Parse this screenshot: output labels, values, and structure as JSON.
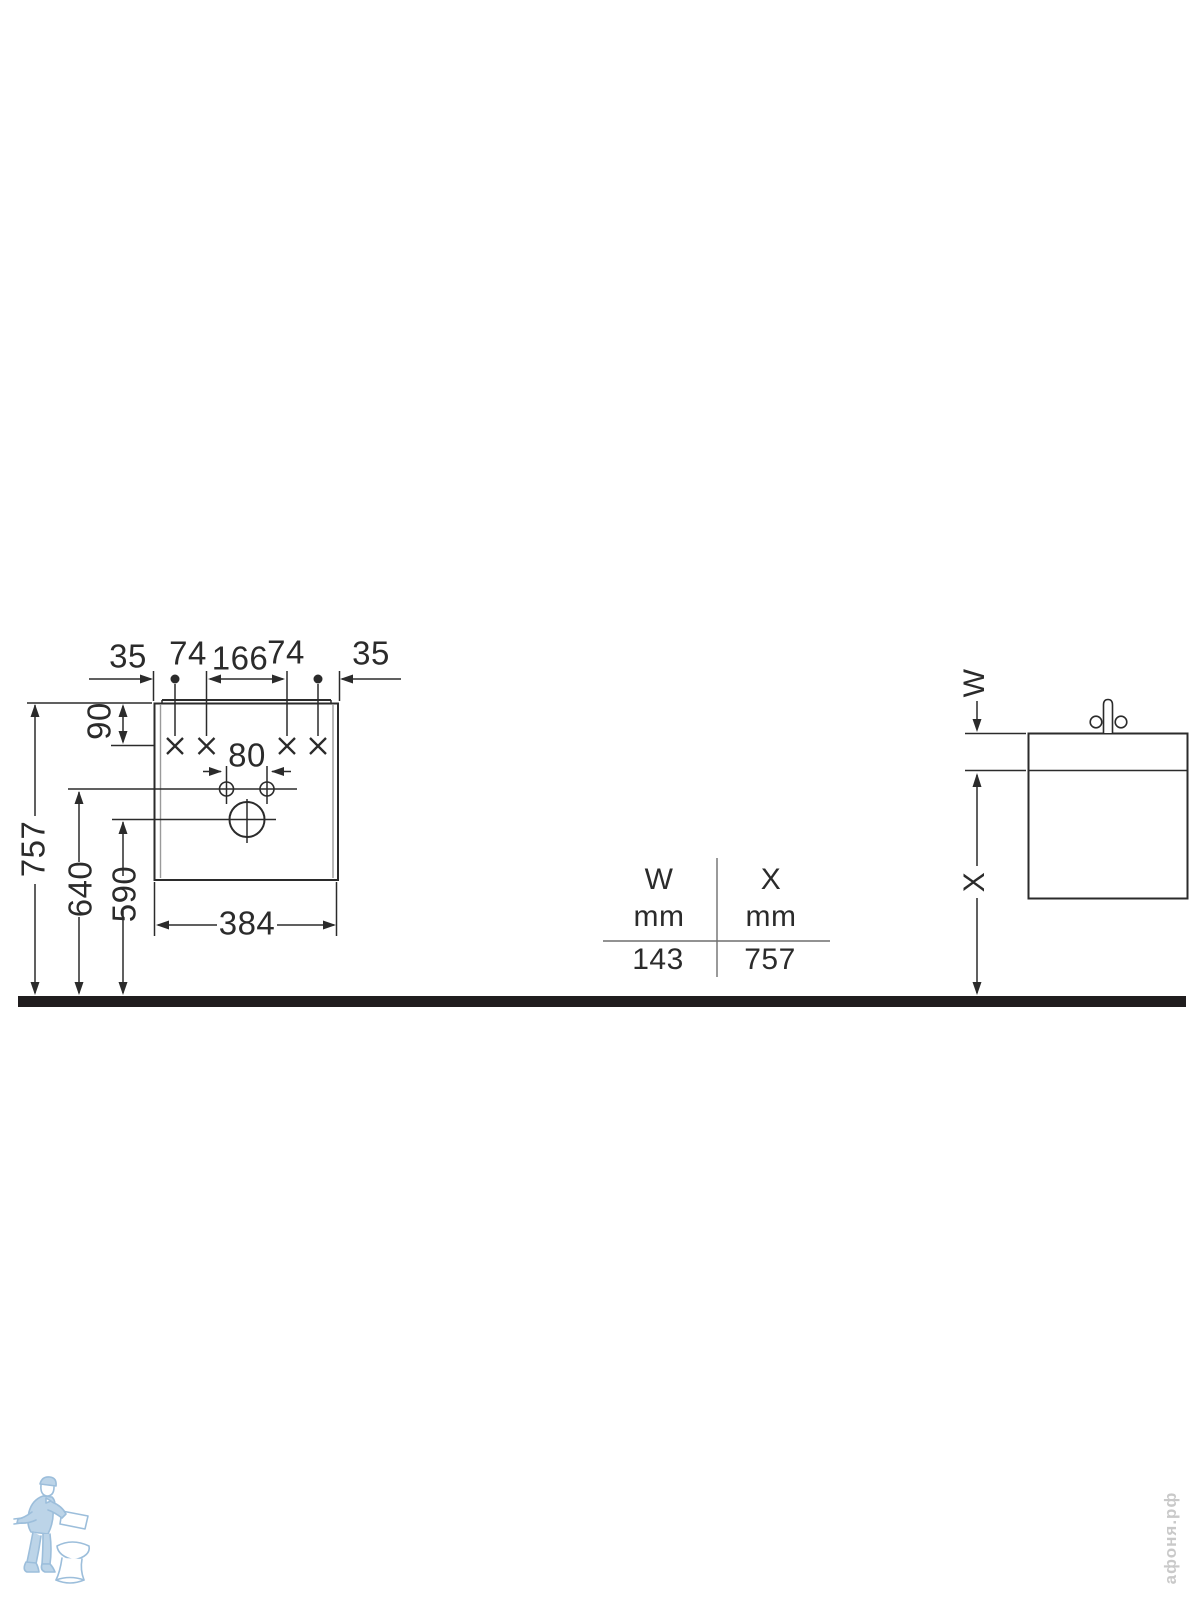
{
  "front_view": {
    "dim_35_left": "35",
    "dim_74_left": "74",
    "dim_166": "166",
    "dim_74_right": "74",
    "dim_35_right": "35",
    "dim_90": "90",
    "dim_80": "80",
    "dim_757": "757",
    "dim_640": "640",
    "dim_590": "590",
    "dim_384": "384"
  },
  "side_view": {
    "dim_w_label": "W",
    "dim_x_label": "X"
  },
  "table": {
    "columns": [
      {
        "label": "W",
        "unit": "mm",
        "value": "143"
      },
      {
        "label": "X",
        "unit": "mm",
        "value": "757"
      }
    ]
  },
  "watermark": {
    "text": "афоня.рф"
  },
  "icons": {
    "faucet": "faucet-icon",
    "logo": "plumber-with-toilet-logo"
  },
  "colors": {
    "line": "#2b2b2b",
    "floor": "#201d1e",
    "inner_panel": "#9a9a9a",
    "table_line": "#6f6f6f",
    "logo_stroke": "#9cbedb",
    "logo_fill": "#d9e7f3",
    "watermark_text": "#c9c9c9"
  }
}
